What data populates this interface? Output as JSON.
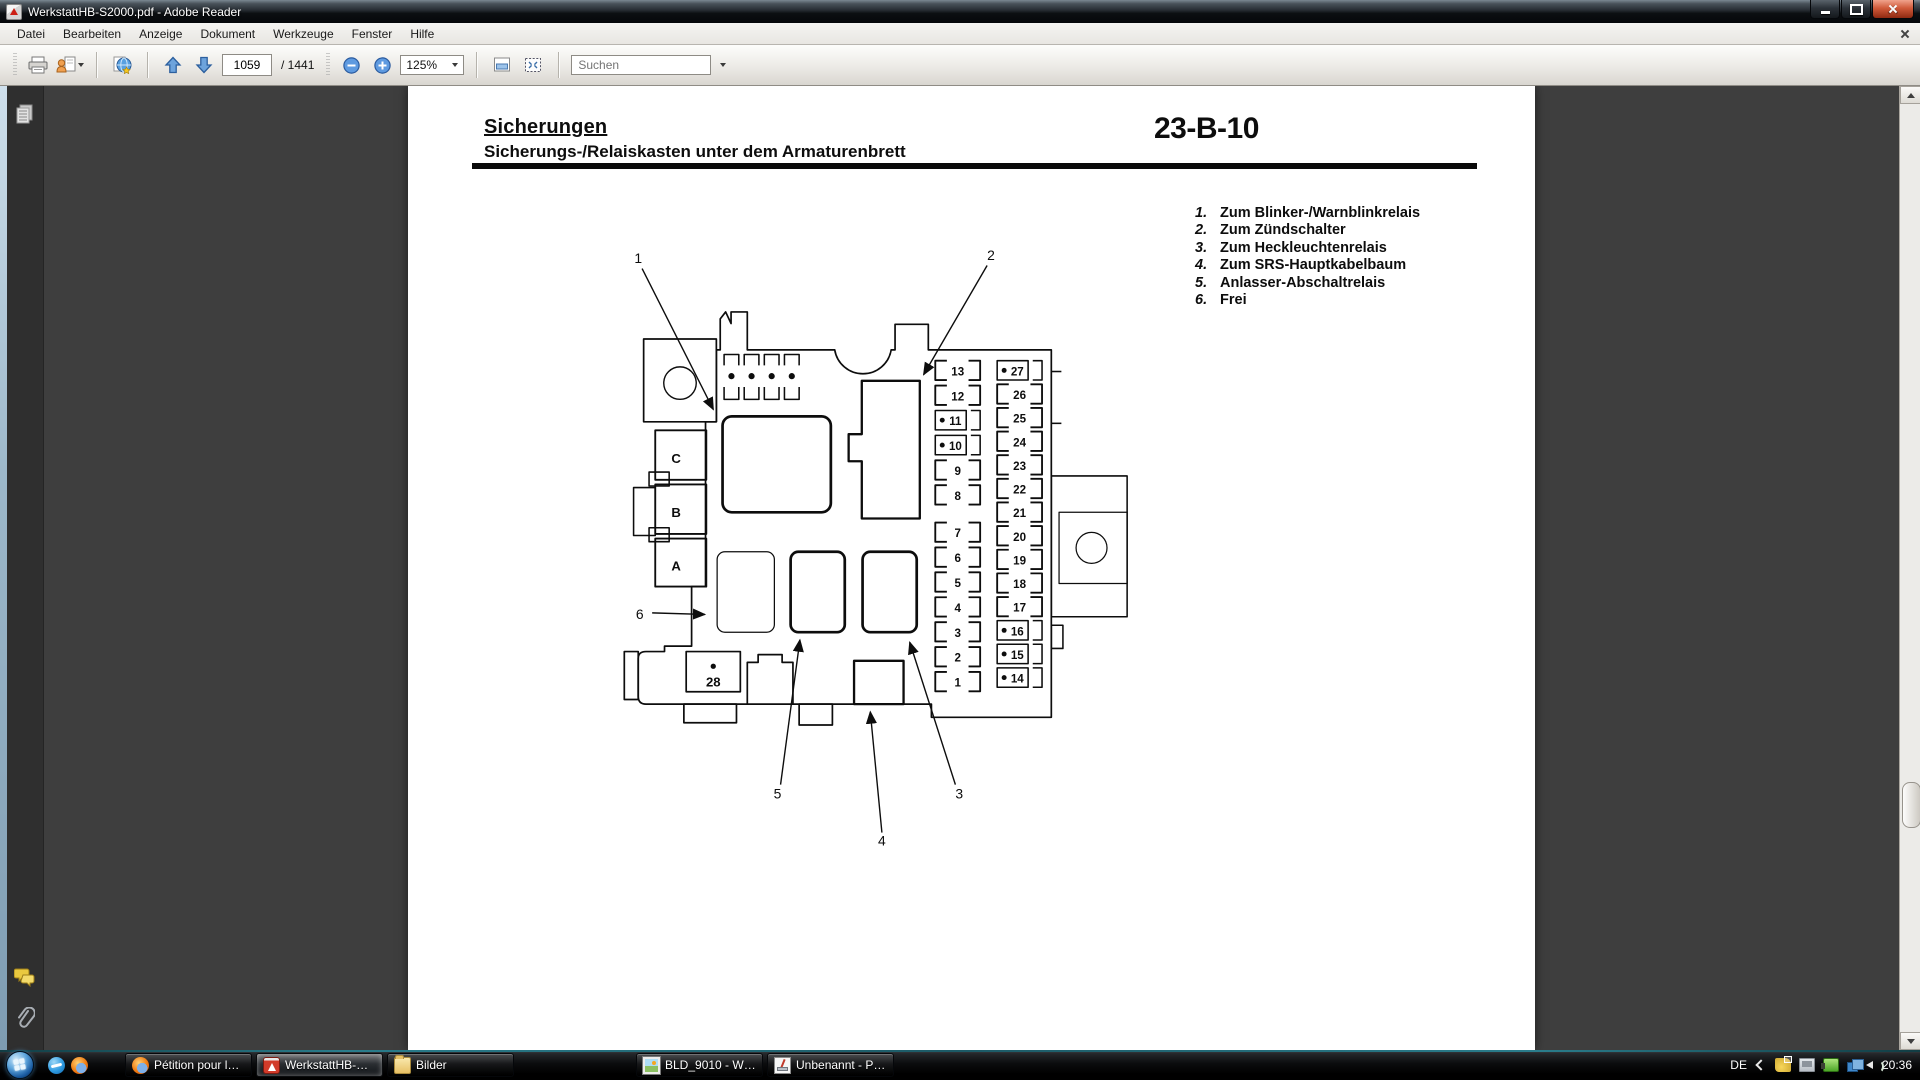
{
  "window": {
    "title": "WerkstattHB-S2000.pdf - Adobe Reader"
  },
  "menu": {
    "items": [
      "Datei",
      "Bearbeiten",
      "Anzeige",
      "Dokument",
      "Werkzeuge",
      "Fenster",
      "Hilfe"
    ]
  },
  "toolbar": {
    "page_current": "1059",
    "page_total": "/ 1441",
    "zoom_level": "125%",
    "search_placeholder": "Suchen"
  },
  "document": {
    "heading": "Sicherungen",
    "subheading": "Sicherungs-/Relaiskasten unter dem Armaturenbrett",
    "page_code": "23-B-10",
    "legend": [
      {
        "num": "1.",
        "text": "Zum Blinker-/Warnblinkrelais"
      },
      {
        "num": "2.",
        "text": "Zum Zündschalter"
      },
      {
        "num": "3.",
        "text": "Zum Heckleuchtenrelais"
      },
      {
        "num": "4.",
        "text": "Zum SRS-Hauptkabelbaum"
      },
      {
        "num": "5.",
        "text": "Anlasser-Abschaltrelais"
      },
      {
        "num": "6.",
        "text": "Frei"
      }
    ]
  },
  "diagram": {
    "callout_labels": [
      "1",
      "2",
      "3",
      "4",
      "5",
      "6"
    ],
    "connector_labels": [
      "C",
      "B",
      "A"
    ],
    "fuse_28": "28",
    "left_fuses": [
      {
        "n": "13"
      },
      {
        "n": "12"
      },
      {
        "n": "11",
        "dot": true
      },
      {
        "n": "10",
        "dot": true
      },
      {
        "n": "9"
      },
      {
        "n": "8"
      },
      {
        "n": "7"
      },
      {
        "n": "6"
      },
      {
        "n": "5"
      },
      {
        "n": "4"
      },
      {
        "n": "3"
      },
      {
        "n": "2"
      },
      {
        "n": "1"
      }
    ],
    "right_fuses": [
      {
        "n": "27",
        "dot": true
      },
      {
        "n": "26"
      },
      {
        "n": "25"
      },
      {
        "n": "24"
      },
      {
        "n": "23"
      },
      {
        "n": "22"
      },
      {
        "n": "21"
      },
      {
        "n": "20"
      },
      {
        "n": "19"
      },
      {
        "n": "18"
      },
      {
        "n": "17"
      },
      {
        "n": "16",
        "dot": true
      },
      {
        "n": "15",
        "dot": true
      },
      {
        "n": "14",
        "dot": true
      }
    ]
  },
  "taskbar": {
    "buttons": [
      {
        "label": "Pétition pour le circ...",
        "icon": "firefox"
      },
      {
        "label": "WerkstattHB-S2000....",
        "icon": "pdf",
        "active": true
      },
      {
        "label": "Bilder",
        "icon": "folder"
      },
      {
        "label": "BLD_9010 - Window...",
        "icon": "photo",
        "gap_before": true
      },
      {
        "label": "Unbenannt - Paint",
        "icon": "paint"
      }
    ],
    "tray": {
      "language": "DE",
      "time": "20:36"
    }
  },
  "colors": {
    "taskbar_accent": "#2a7d8c",
    "close_button": "#d05a3a",
    "page_background": "#ffffff",
    "workspace_background": "#3e3e3e",
    "diagram_ink": "#0d0d0d"
  }
}
